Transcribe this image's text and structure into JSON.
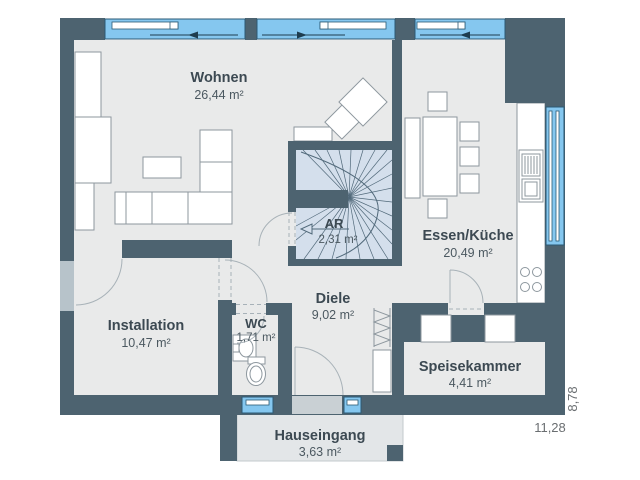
{
  "plan": {
    "type": "floorplan-ground-floor",
    "rooms": {
      "wohnen": {
        "name": "Wohnen",
        "area": "26,44 m²"
      },
      "essen_kueche": {
        "name": "Essen/Küche",
        "area": "20,49 m²"
      },
      "diele": {
        "name": "Diele",
        "area": "9,02 m²"
      },
      "ar": {
        "name": "AR",
        "area": "2,31 m²"
      },
      "wc": {
        "name": "WC",
        "area": "1,71 m²"
      },
      "installation": {
        "name": "Installation",
        "area": "10,47 m²"
      },
      "speisekammer": {
        "name": "Speisekammer",
        "area": "4,41 m²"
      },
      "hauseingang": {
        "name": "Hauseingang",
        "area": "3,63 m²"
      }
    },
    "dimensions": {
      "width_m": "11,28",
      "height_m": "8,78"
    },
    "colors": {
      "wall": "#4d6370",
      "window_glass": "#85c7ef",
      "floor": "#e9eaea",
      "stairs": "#d4dfec",
      "porch": "#e3e6e8"
    }
  }
}
